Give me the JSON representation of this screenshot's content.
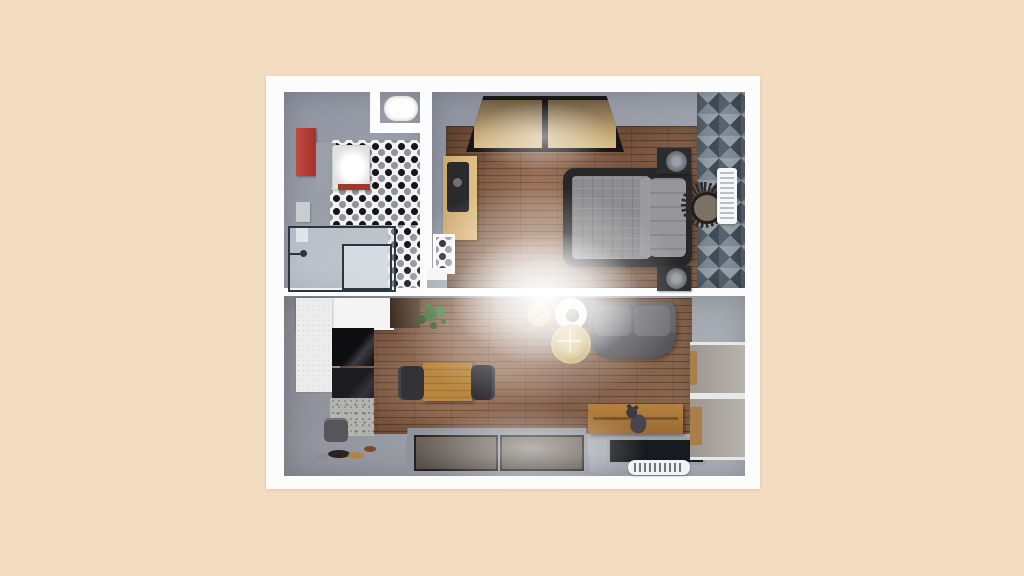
{
  "scene": {
    "type": "3d-floor-plan-render",
    "description": "Top-down 3D render of a one-bedroom apartment on a peach background",
    "canvas_background": "#f4dcc0",
    "plan_frame_color": "#fcfcfc",
    "rooms": [
      {
        "id": "bathroom",
        "label": "Bathroom",
        "floor": "gray concrete with black-and-white mosaic tile",
        "furniture": [
          "red vanity cabinet",
          "white sink unit",
          "toilet in niche",
          "glass shower enclosure",
          "toiletry shelves"
        ]
      },
      {
        "id": "bedroom",
        "label": "Bedroom",
        "floor": "walnut plank with gray border",
        "furniture": [
          "double bed with gray bedding",
          "nightstand with round lamp (top)",
          "nightstand with round lamp (bottom)",
          "desk with dark chair",
          "sliding-door wardrobe window",
          "geometric triangle accent rug",
          "sunburst mirror",
          "white radiator",
          "tiled niche"
        ]
      },
      {
        "id": "living-room",
        "label": "Living room and kitchen",
        "floor": "walnut plank with gray walkway",
        "furniture": [
          "white kitchen counter",
          "black cooktop and oven column",
          "granite block",
          "dark wall cabinet",
          "green plant",
          "trash bin",
          "pet bowls",
          "wood dining table",
          "dining chair left",
          "dining chair right",
          "gray loveseat sofa",
          "white round side table with plant",
          "gold tray table",
          "round gold coffee table",
          "wood TV sideboard",
          "cat on sideboard",
          "wall TV panel",
          "white floor vent",
          "bottom double window",
          "right wall windows"
        ]
      }
    ],
    "palette": {
      "background": "#f4dcc0",
      "wall": "#fcfcfc",
      "gray_floor": "#9ba0aa",
      "wood_dark": "#75513c",
      "wood_light": "#8f6b52",
      "accent_red": "#b23b33",
      "bed_frame": "#27272a",
      "mattress": "#8d8d8f",
      "sofa_gray": "#616165",
      "tile_black": "#17171a",
      "tile_gray": "#8e939c",
      "accent_wall_dark": "#414c58",
      "accent_wall_light": "#98a1aa",
      "table_wood": "#b8873f",
      "sideboard_wood": "#a9763b",
      "gold": "#c7ae6b",
      "plant_green": "#3e6b34"
    }
  }
}
